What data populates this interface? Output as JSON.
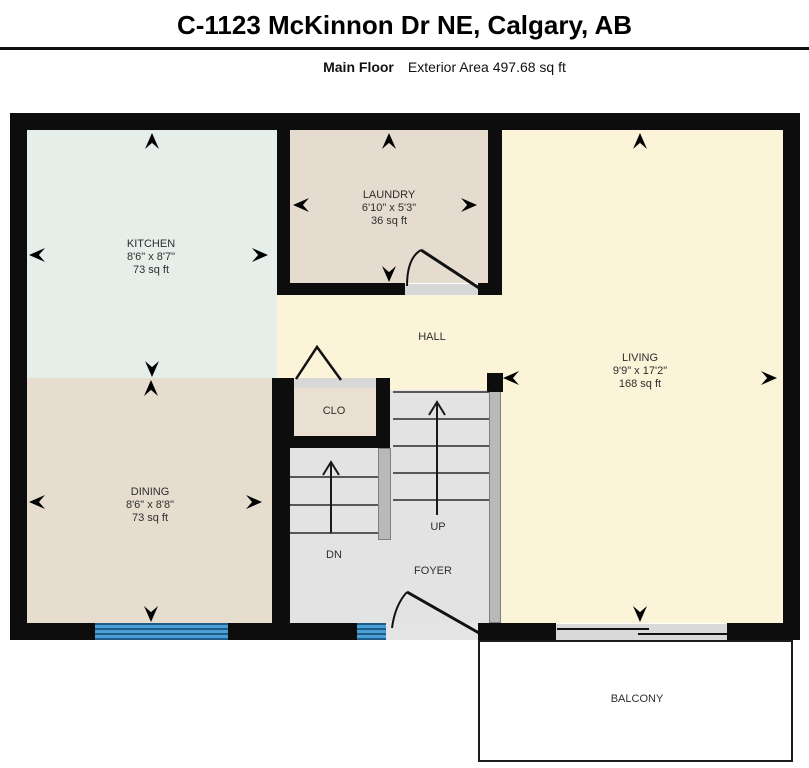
{
  "header": {
    "title": "C-1123 McKinnon Dr NE, Calgary, AB",
    "floor_label": "Main Floor",
    "area_label": "Exterior Area 497.68 sq ft"
  },
  "rooms": {
    "kitchen": {
      "label": "KITCHEN",
      "dims": "8'6\" x 8'7\"",
      "area": "73 sq ft"
    },
    "laundry": {
      "label": "LAUNDRY",
      "dims": "6'10\" x 5'3\"",
      "area": "36 sq ft"
    },
    "living": {
      "label": "LIVING",
      "dims": "9'9\" x 17'2\"",
      "area": "168 sq ft"
    },
    "dining": {
      "label": "DINING",
      "dims": "8'6\" x 8'8\"",
      "area": "73 sq ft"
    },
    "hall": {
      "label": "HALL"
    },
    "closet": {
      "label": "CLO"
    },
    "foyer": {
      "label": "FOYER"
    },
    "balcony": {
      "label": "BALCONY"
    }
  },
  "stairs": {
    "up_label": "UP",
    "down_label": "DN"
  },
  "colors": {
    "wall": "#0d0d0d",
    "kitchen": "#e5eee9",
    "laundry": "#e5dccf",
    "living": "#fbf4d9",
    "hall": "#fbf4d9",
    "dining": "#e6ddcf",
    "closet_interior": "#e9e0d2",
    "foyer": "#e3e3e3",
    "stair_rail": "#b9b9b9",
    "window_blue": "#4aa0d5",
    "balcony": "#ffffff"
  }
}
